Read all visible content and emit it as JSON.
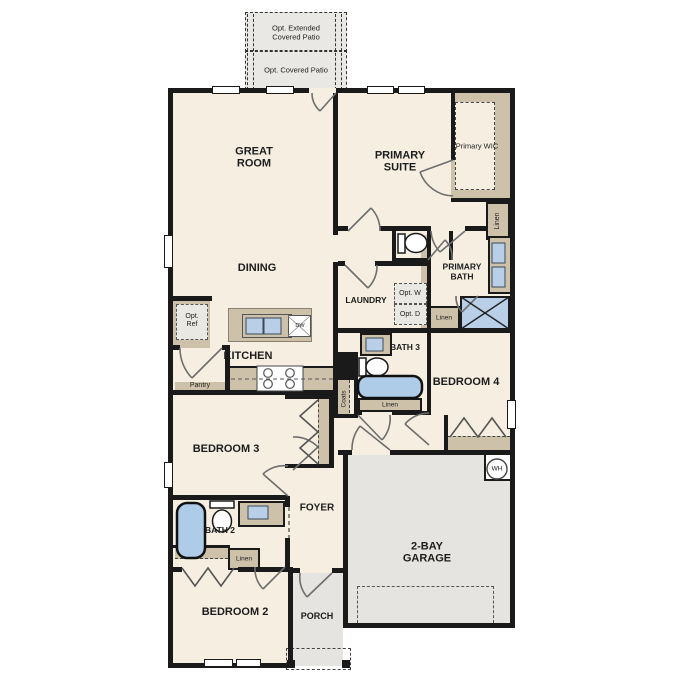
{
  "plan_title": "Floor plan",
  "patio": {
    "extended": "Opt. Extended Covered Patio",
    "covered": "Opt. Covered Patio"
  },
  "rooms": {
    "great_room": "GREAT ROOM",
    "dining": "DINING",
    "kitchen": "KITCHEN",
    "primary_suite": "PRIMARY SUITE",
    "primary_bath": "PRIMARY BATH",
    "laundry": "LAUNDRY",
    "bath_3": "BATH 3",
    "bedroom_4": "BEDROOM 4",
    "bedroom_3": "BEDROOM 3",
    "foyer": "FOYER",
    "bath_2": "BATH 2",
    "bedroom_2": "BEDROOM 2",
    "porch": "PORCH",
    "garage": "2-BAY GARAGE"
  },
  "closets": {
    "primary_wic": "Primary WIC",
    "linen_hall": "Linen",
    "linen_primary_bath": "Linen",
    "linen_bath3": "Linen",
    "linen_bedroom2": "Linen",
    "coats": "Coats",
    "pantry": "Pantry"
  },
  "options": {
    "refrigerator": "Opt. Ref",
    "washer": "Opt. W",
    "dryer": "Opt. D"
  },
  "appliances": {
    "dishwasher": "DW",
    "water_heater": "WH"
  },
  "colors": {
    "wall": "#1a1a1a",
    "floor": "#f6efe1",
    "concrete": "#e6e4e0",
    "cabinet": "#cdc1a9",
    "fixture": "#b9cfe7",
    "door_arc": "#6e6e6e"
  }
}
